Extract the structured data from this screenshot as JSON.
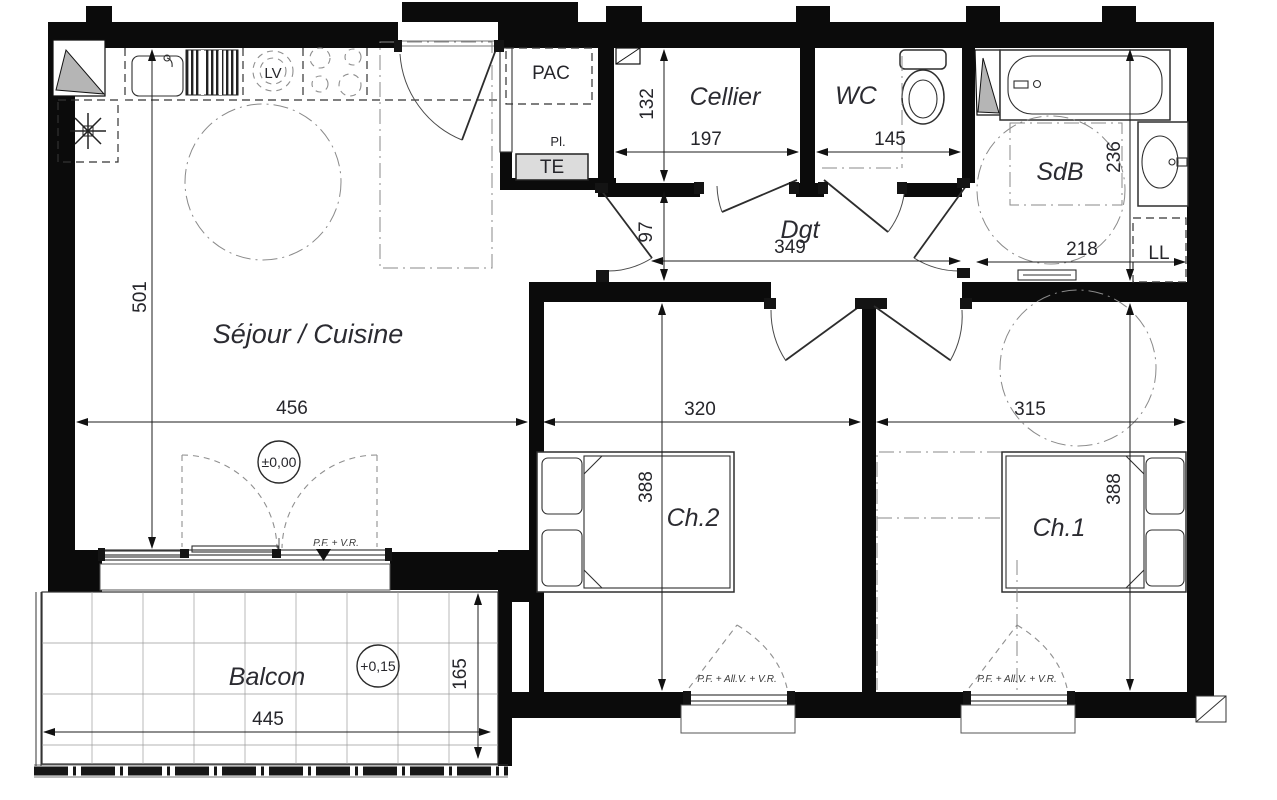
{
  "plan": {
    "rooms": {
      "sejour": {
        "label": "Séjour / Cuisine",
        "width": "456",
        "height": "501",
        "level": "±0,00"
      },
      "cellier": {
        "label": "Cellier",
        "width": "197",
        "height": "132"
      },
      "wc": {
        "label": "WC",
        "width": "145"
      },
      "sdb": {
        "label": "SdB",
        "width": "218",
        "height": "236"
      },
      "dgt": {
        "label": "Dgt",
        "width": "349",
        "height": "97"
      },
      "ch2": {
        "label": "Ch.2",
        "width": "320",
        "height": "388"
      },
      "ch1": {
        "label": "Ch.1",
        "width": "315",
        "height": "388"
      },
      "balcon": {
        "label": "Balcon",
        "width": "445",
        "height": "165",
        "level": "+0,15"
      }
    },
    "equipment": {
      "pac": "PAC",
      "placard": "Pl.",
      "tableau_electrique": "TE",
      "lave_vaisselle": "LV",
      "lave_linge": "LL"
    },
    "windows": {
      "sejour": "P.F. + V.R.",
      "ch2": "P.F. + All.V. + V.R.",
      "ch1": "P.F. + All.V. + V.R."
    }
  }
}
